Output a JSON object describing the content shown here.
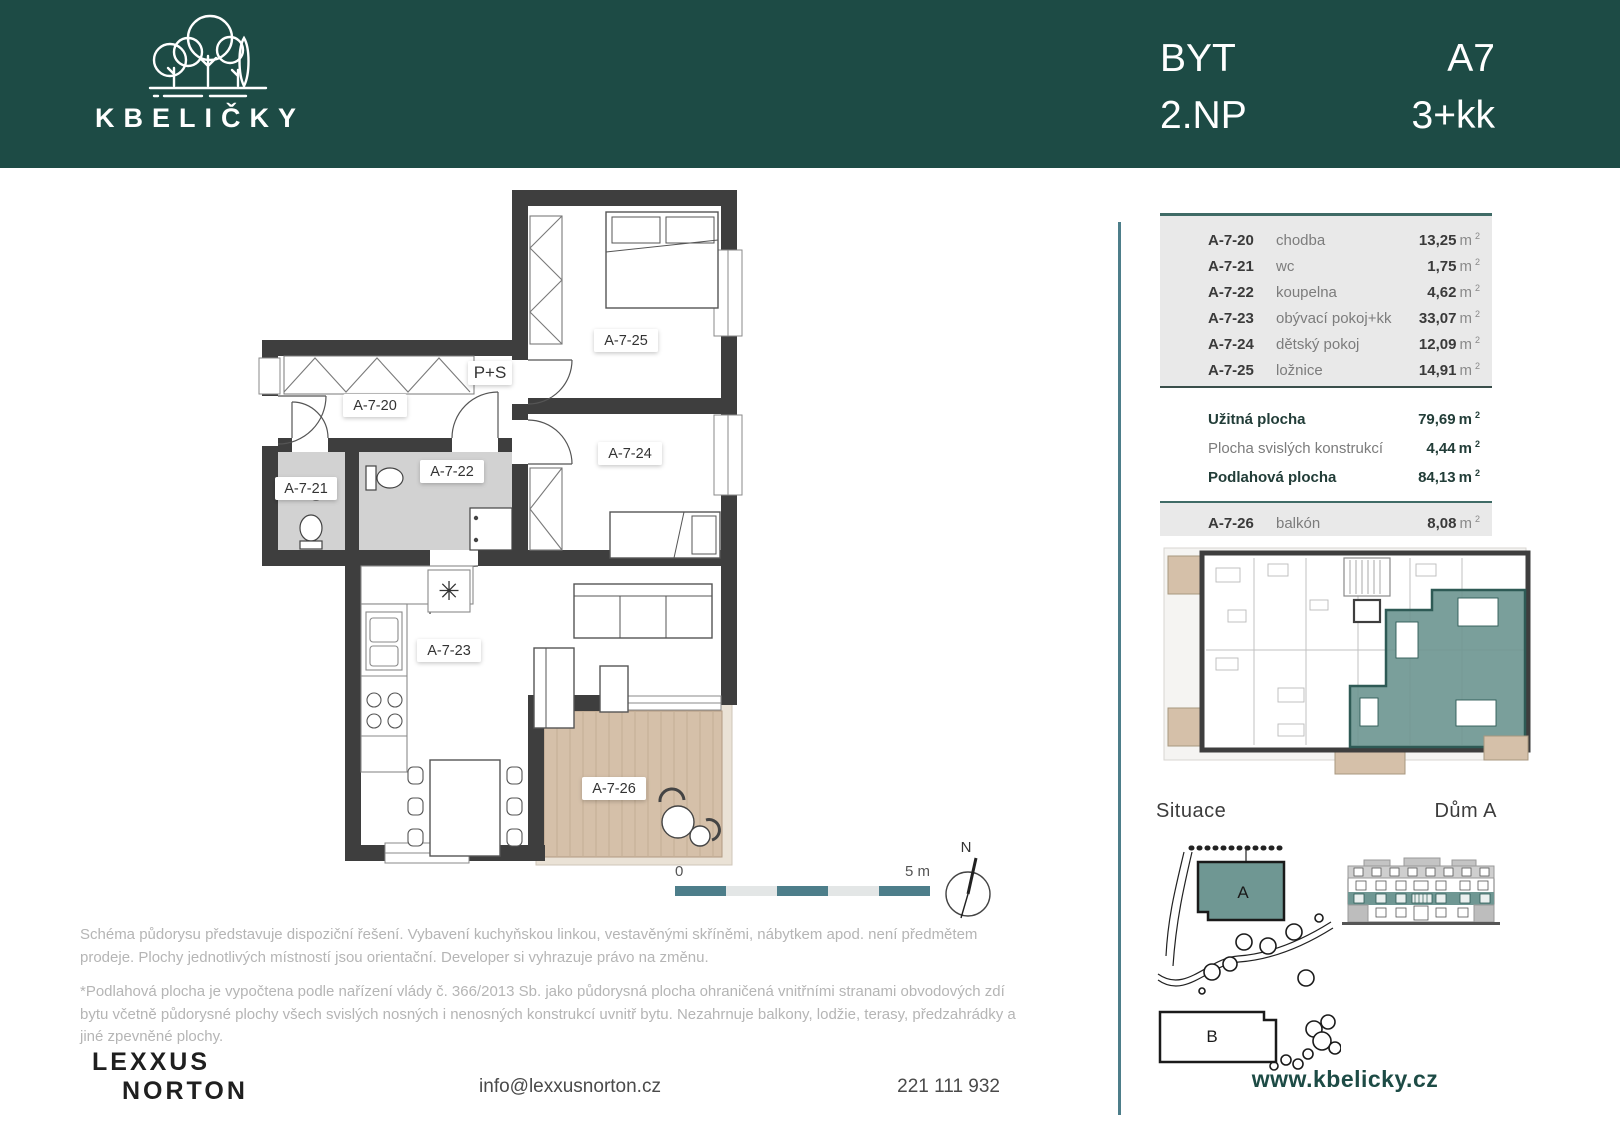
{
  "header": {
    "logo_text": "KBELIČKY",
    "left": {
      "line1": "BYT",
      "line2": "2.NP"
    },
    "right": {
      "line1": "A7",
      "line2": "3+kk"
    }
  },
  "units": {
    "m": "m",
    "sup": "2"
  },
  "table": {
    "rows": [
      {
        "code": "A-7-20",
        "name": "chodba",
        "area": "13,25"
      },
      {
        "code": "A-7-21",
        "name": "wc",
        "area": "1,75"
      },
      {
        "code": "A-7-22",
        "name": "koupelna",
        "area": "4,62"
      },
      {
        "code": "A-7-23",
        "name": "obývací pokoj+kk",
        "area": "33,07"
      },
      {
        "code": "A-7-24",
        "name": "dětský pokoj",
        "area": "12,09"
      },
      {
        "code": "A-7-25",
        "name": "ložnice",
        "area": "14,91"
      }
    ],
    "summary": [
      {
        "label": "Užitná plocha",
        "value": "79,69"
      },
      {
        "label": "Plocha svislých konstrukcí",
        "value": "4,44"
      },
      {
        "label": "Podlahová plocha",
        "value": "84,13"
      }
    ],
    "balcony": {
      "code": "A-7-26",
      "name": "balkón",
      "area": "8,08"
    }
  },
  "plan": {
    "labels": [
      "A-7-20",
      "A-7-21",
      "A-7-22",
      "A-7-23",
      "A-7-24",
      "A-7-25",
      "A-7-26"
    ],
    "wardrobe": "P+S",
    "vent_symbol": "✳",
    "scale_start": "0",
    "scale_end": "5 m",
    "north": "N"
  },
  "right_column": {
    "situace_label": "Situace",
    "dum_label": "Dům A",
    "building_a": "A",
    "building_b": "B"
  },
  "disclaimer": {
    "p1": "Schéma půdorysu představuje dispoziční řešení. Vybavení kuchyňskou linkou, vestavěnými skříněmi, nábytkem apod. není předmětem prodeje. Plochy jednotlivých místností jsou orientační. Developer si vyhrazuje právo na změnu.",
    "p2": "*Podlahová plocha je vypočtena podle nařízení vlády č. 366/2013 Sb. jako půdorysná plocha ohraničená vnitřními stranami obvodových zdí bytu včetně půdorysné plochy všech svislých nosných i nenosných konstrukcí uvnitř bytu. Nezahrnuje balkony, lodžie, terasy, předzahrádky a jiné zpevněné plochy."
  },
  "footer": {
    "brand_line1": "LEXXUS",
    "brand_line2": "NORTON",
    "email": "info@lexxusnorton.cz",
    "phone": "221 111 932",
    "website": "www.kbelicky.cz"
  },
  "colors": {
    "header-bg": "#1d4b45",
    "accent": "#4d7e8a",
    "wall": "#3e3e3e",
    "highlight": "#6f9793",
    "beige": "#d5c0a9"
  }
}
